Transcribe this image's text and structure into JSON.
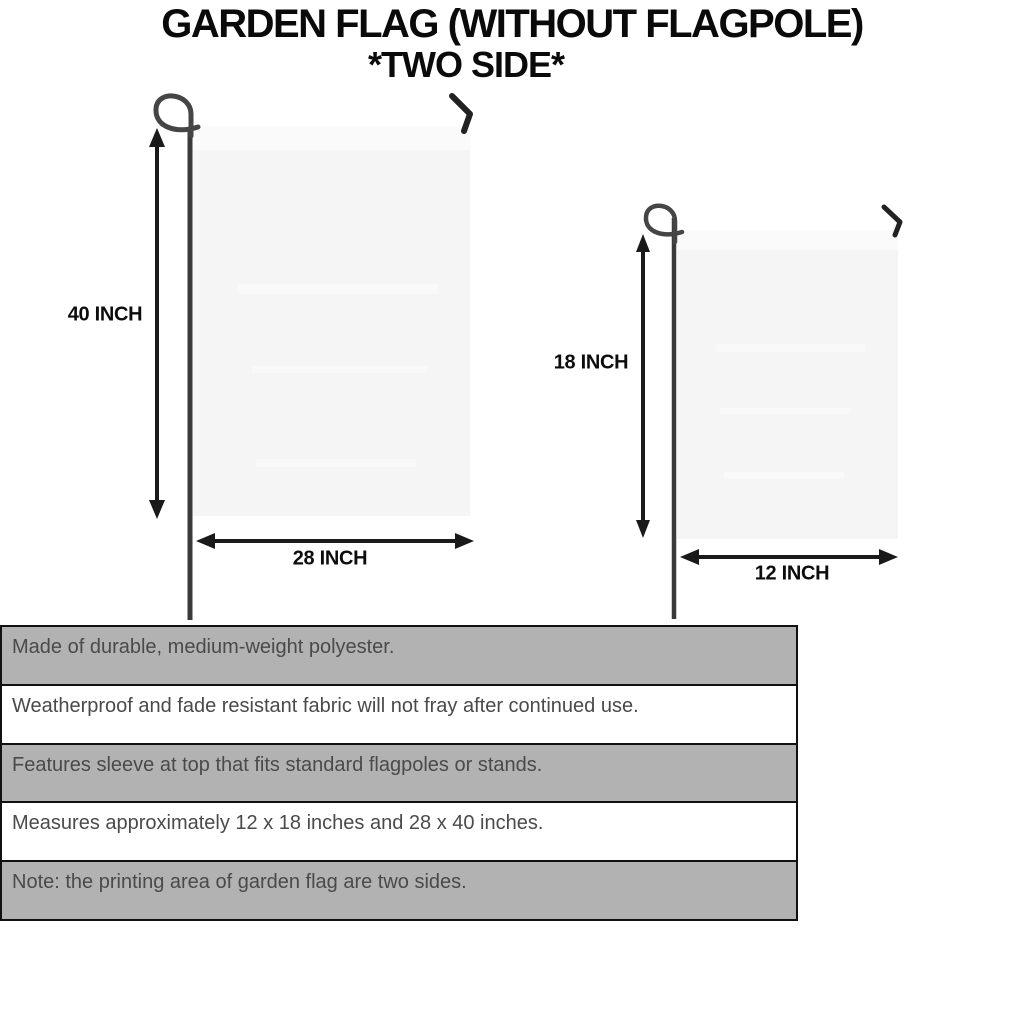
{
  "header": {
    "title": "GARDEN FLAG (WITHOUT FLAGPOLE)",
    "subtitle": "*TWO SIDE*"
  },
  "diagram": {
    "large_flag": {
      "height_label": "40 INCH",
      "width_label": "28 INCH"
    },
    "small_flag": {
      "height_label": "18 INCH",
      "width_label": "12 INCH"
    }
  },
  "spec_table": {
    "rows": [
      {
        "text": "Made of durable, medium-weight polyester."
      },
      {
        "text": "Weatherproof and fade resistant fabric will not fray after continued use."
      },
      {
        "text": "Features sleeve at top that fits standard flagpoles or stands."
      },
      {
        "text": "Measures approximately 12 x 18 inches and 28 x 40 inches."
      },
      {
        "text": "Note: the printing area of garden flag are two sides."
      }
    ]
  },
  "colors": {
    "row_gray": "#b2b2b2",
    "row_white": "#ffffff",
    "table_border": "#111111",
    "table_text": "#4a4a4a",
    "flag_fill": "#f5f5f5",
    "flag_sleeve": "#fafafa",
    "pole": "#3a3a3a",
    "dimension_arrow": "#1a1a1a",
    "title_text": "#0a0a0a"
  }
}
